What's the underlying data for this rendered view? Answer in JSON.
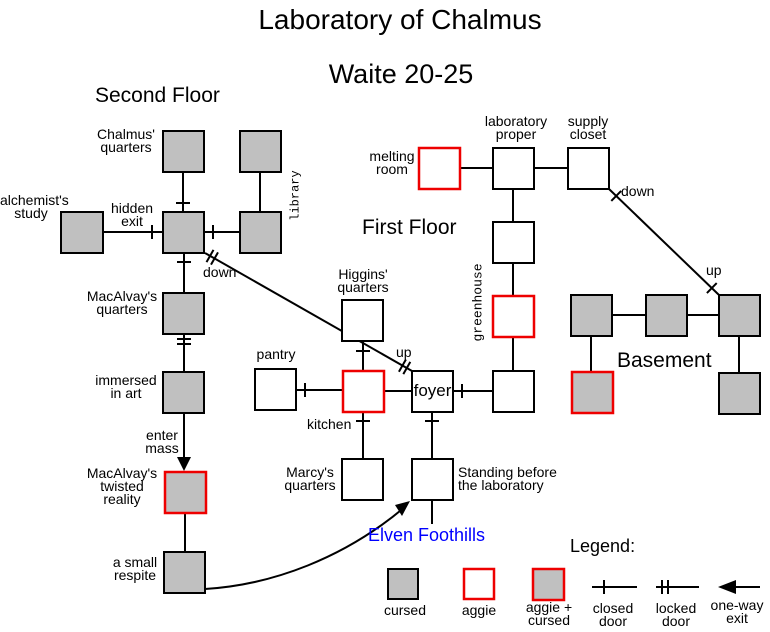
{
  "title": "Laboratory of Chalmus",
  "subtitle": "Waite 20-25",
  "headings": {
    "second_floor": "Second Floor",
    "first_floor": "First Floor",
    "basement": "Basement",
    "region": "Elven Foothills"
  },
  "rooms": {
    "chalmus_quarters": "Chalmus'\nquarters",
    "library": "library",
    "alchemists_study": "alchemist's\nstudy",
    "macalvays_quarters": "MacAlvay's\nquarters",
    "immersed_in_art": "immersed\nin art",
    "macalvays_twisted_reality": "MacAlvay's\ntwisted\nreality",
    "a_small_respite": "a small\nrespite",
    "higgins_quarters": "Higgins'\nquarters",
    "pantry": "pantry",
    "kitchen": "kitchen",
    "foyer": "foyer",
    "marcys_quarters": "Marcy's\nquarters",
    "standing_before": "Standing before\nthe laboratory",
    "melting_room": "melting\nroom",
    "laboratory_proper": "laboratory\nproper",
    "supply_closet": "supply\ncloset",
    "greenhouse": "greenhouse"
  },
  "edge_labels": {
    "hidden_exit": "hidden\nexit",
    "down_to_first": "down",
    "up_to_second": "up",
    "enter_mass": "enter\nmass",
    "down_to_basement": "down",
    "up_to_first": "up"
  },
  "legend": {
    "heading": "Legend:",
    "cursed": "cursed",
    "aggie": "aggie",
    "aggie_cursed": "aggie +\ncursed",
    "closed_door": "closed\ndoor",
    "locked_door": "locked\ndoor",
    "one_way_exit": "one-way\nexit"
  },
  "colors": {
    "cursed_fill": "#c0c0c0",
    "room_fill": "#ffffff",
    "aggie_border": "#ee0000",
    "line": "#000000",
    "region_text": "#0000ff"
  }
}
